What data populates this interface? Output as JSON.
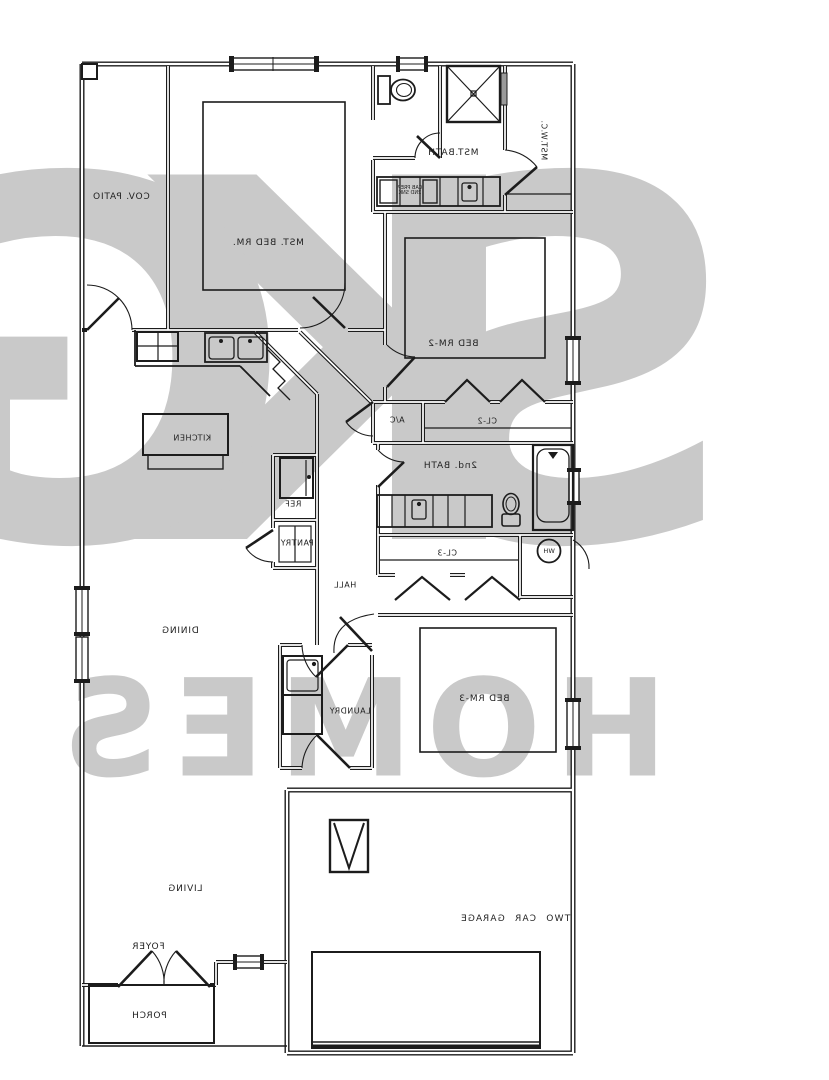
{
  "watermark": {
    "line1": "SKG",
    "line2": "HOMES",
    "color": "#c9c9c9"
  },
  "line_color": "#1c1c1c",
  "rooms": {
    "cov_patio": "COV. PATIO",
    "mst_bed_rm": "MST. BED RM.",
    "mst_bath": "MST.BATH",
    "mst_wc": "MST.W.C.",
    "bed_rm_2": "BED RM-2",
    "cl_2": "CL-2",
    "ac": "A/C",
    "second_bath": "2nd. BATH",
    "cl_3": "CL-3",
    "wh": "WH",
    "hall": "HALL",
    "ref": "REF",
    "pantry": "PANTRY",
    "kitchen": "KITCHEN",
    "dining": "DINING",
    "laundry": "LAUNDRY",
    "bed_rm_3": "BED RM-3",
    "living": "LIVING",
    "foyer": "FOYER",
    "porch": "PORCH",
    "garage": "TWO CAR GARAGE",
    "vanity_note_line1": "CAB PREP",
    "vanity_note_line2": "2ND SNK"
  }
}
